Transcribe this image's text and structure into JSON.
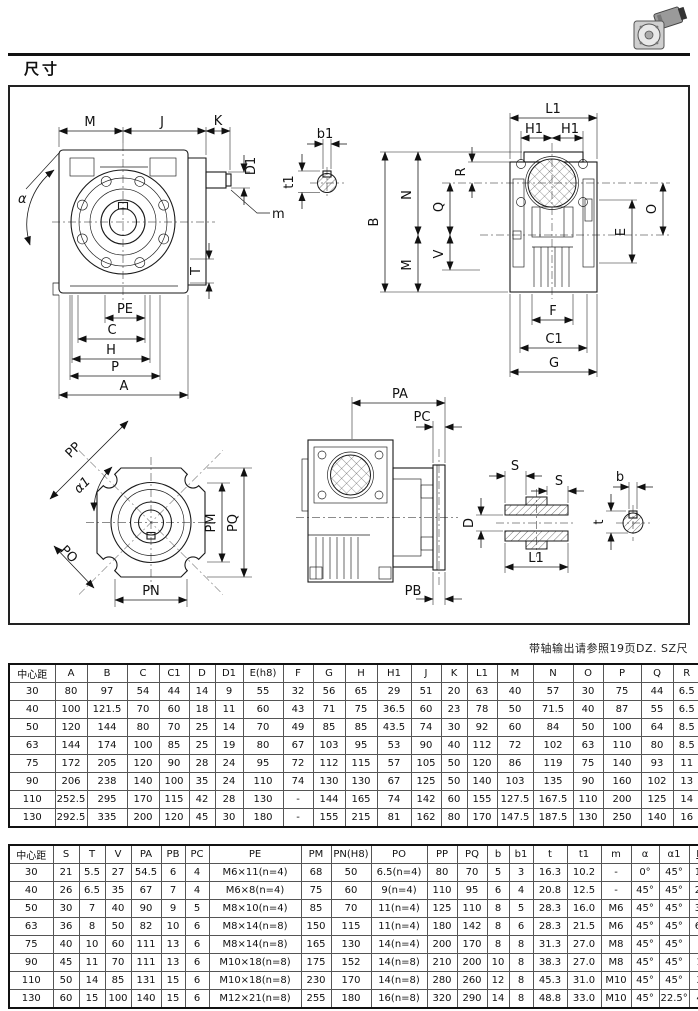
{
  "page": {
    "title": "尺寸",
    "note": "带轴输出请参照19页DZ. SZ尺"
  },
  "drawing": {
    "labels": {
      "M": "M",
      "J": "J",
      "K": "K",
      "D1": "D1",
      "alpha": "α",
      "m": "m",
      "T": "T",
      "PE": "PE",
      "C": "C",
      "H": "H",
      "P": "P",
      "A": "A",
      "b1": "b1",
      "t1": "t1",
      "L1": "L1",
      "H1": "H1",
      "B": "B",
      "N": "N",
      "Q": "Q",
      "R": "R",
      "V": "V",
      "O": "O",
      "E": "E",
      "F": "F",
      "C1": "C1",
      "G": "G",
      "PP": "PP",
      "alpha1": "α1",
      "PO": "PO",
      "PM": "PM",
      "PQ": "PQ",
      "PN": "PN",
      "PA": "PA",
      "PC": "PC",
      "PB": "PB",
      "S": "S",
      "D": "D",
      "b": "b",
      "t": "t"
    }
  },
  "table1": {
    "columns": [
      "中心距",
      "A",
      "B",
      "C",
      "C1",
      "D",
      "D1",
      "E(h8)",
      "F",
      "G",
      "H",
      "H1",
      "J",
      "K",
      "L1",
      "M",
      "N",
      "O",
      "P",
      "Q",
      "R"
    ],
    "rows": [
      [
        "30",
        "80",
        "97",
        "54",
        "44",
        "14",
        "9",
        "55",
        "32",
        "56",
        "65",
        "29",
        "51",
        "20",
        "63",
        "40",
        "57",
        "30",
        "75",
        "44",
        "6.5"
      ],
      [
        "40",
        "100",
        "121.5",
        "70",
        "60",
        "18",
        "11",
        "60",
        "43",
        "71",
        "75",
        "36.5",
        "60",
        "23",
        "78",
        "50",
        "71.5",
        "40",
        "87",
        "55",
        "6.5"
      ],
      [
        "50",
        "120",
        "144",
        "80",
        "70",
        "25",
        "14",
        "70",
        "49",
        "85",
        "85",
        "43.5",
        "74",
        "30",
        "92",
        "60",
        "84",
        "50",
        "100",
        "64",
        "8.5"
      ],
      [
        "63",
        "144",
        "174",
        "100",
        "85",
        "25",
        "19",
        "80",
        "67",
        "103",
        "95",
        "53",
        "90",
        "40",
        "112",
        "72",
        "102",
        "63",
        "110",
        "80",
        "8.5"
      ],
      [
        "75",
        "172",
        "205",
        "120",
        "90",
        "28",
        "24",
        "95",
        "72",
        "112",
        "115",
        "57",
        "105",
        "50",
        "120",
        "86",
        "119",
        "75",
        "140",
        "93",
        "11"
      ],
      [
        "90",
        "206",
        "238",
        "140",
        "100",
        "35",
        "24",
        "110",
        "74",
        "130",
        "130",
        "67",
        "125",
        "50",
        "140",
        "103",
        "135",
        "90",
        "160",
        "102",
        "13"
      ],
      [
        "110",
        "252.5",
        "295",
        "170",
        "115",
        "42",
        "28",
        "130",
        "-",
        "144",
        "165",
        "74",
        "142",
        "60",
        "155",
        "127.5",
        "167.5",
        "110",
        "200",
        "125",
        "14"
      ],
      [
        "130",
        "292.5",
        "335",
        "200",
        "120",
        "45",
        "30",
        "180",
        "-",
        "155",
        "215",
        "81",
        "162",
        "80",
        "170",
        "147.5",
        "187.5",
        "130",
        "250",
        "140",
        "16"
      ]
    ]
  },
  "table2": {
    "columns": [
      "中心距",
      "S",
      "T",
      "V",
      "PA",
      "PB",
      "PC",
      "PE",
      "PM",
      "PN(H8)",
      "PO",
      "PP",
      "PQ",
      "b",
      "b1",
      "t",
      "t1",
      "m",
      "α",
      "α1",
      "Kg"
    ],
    "rows": [
      [
        "30",
        "21",
        "5.5",
        "27",
        "54.5",
        "6",
        "4",
        "M6×11(n=4)",
        "68",
        "50",
        "6.5(n=4)",
        "80",
        "70",
        "5",
        "3",
        "16.3",
        "10.2",
        "-",
        "0°",
        "45°",
        "1.2"
      ],
      [
        "40",
        "26",
        "6.5",
        "35",
        "67",
        "7",
        "4",
        "M6×8(n=4)",
        "75",
        "60",
        "9(n=4)",
        "110",
        "95",
        "6",
        "4",
        "20.8",
        "12.5",
        "-",
        "45°",
        "45°",
        "2.3"
      ],
      [
        "50",
        "30",
        "7",
        "40",
        "90",
        "9",
        "5",
        "M8×10(n=4)",
        "85",
        "70",
        "11(n=4)",
        "125",
        "110",
        "8",
        "5",
        "28.3",
        "16.0",
        "M6",
        "45°",
        "45°",
        "3.5"
      ],
      [
        "63",
        "36",
        "8",
        "50",
        "82",
        "10",
        "6",
        "M8×14(n=8)",
        "150",
        "115",
        "11(n=4)",
        "180",
        "142",
        "8",
        "6",
        "28.3",
        "21.5",
        "M6",
        "45°",
        "45°",
        "6.2"
      ],
      [
        "75",
        "40",
        "10",
        "60",
        "111",
        "13",
        "6",
        "M8×14(n=8)",
        "165",
        "130",
        "14(n=4)",
        "200",
        "170",
        "8",
        "8",
        "31.3",
        "27.0",
        "M8",
        "45°",
        "45°",
        "9"
      ],
      [
        "90",
        "45",
        "11",
        "70",
        "111",
        "13",
        "6",
        "M10×18(n=8)",
        "175",
        "152",
        "14(n=8)",
        "210",
        "200",
        "10",
        "8",
        "38.3",
        "27.0",
        "M8",
        "45°",
        "45°",
        "13"
      ],
      [
        "110",
        "50",
        "14",
        "85",
        "131",
        "15",
        "6",
        "M10×18(n=8)",
        "230",
        "170",
        "14(n=8)",
        "280",
        "260",
        "12",
        "8",
        "45.3",
        "31.0",
        "M10",
        "45°",
        "45°",
        "35"
      ],
      [
        "130",
        "60",
        "15",
        "100",
        "140",
        "15",
        "6",
        "M12×21(n=8)",
        "255",
        "180",
        "16(n=8)",
        "320",
        "290",
        "14",
        "8",
        "48.8",
        "33.0",
        "M10",
        "45°",
        "22.5°",
        "48"
      ]
    ]
  }
}
